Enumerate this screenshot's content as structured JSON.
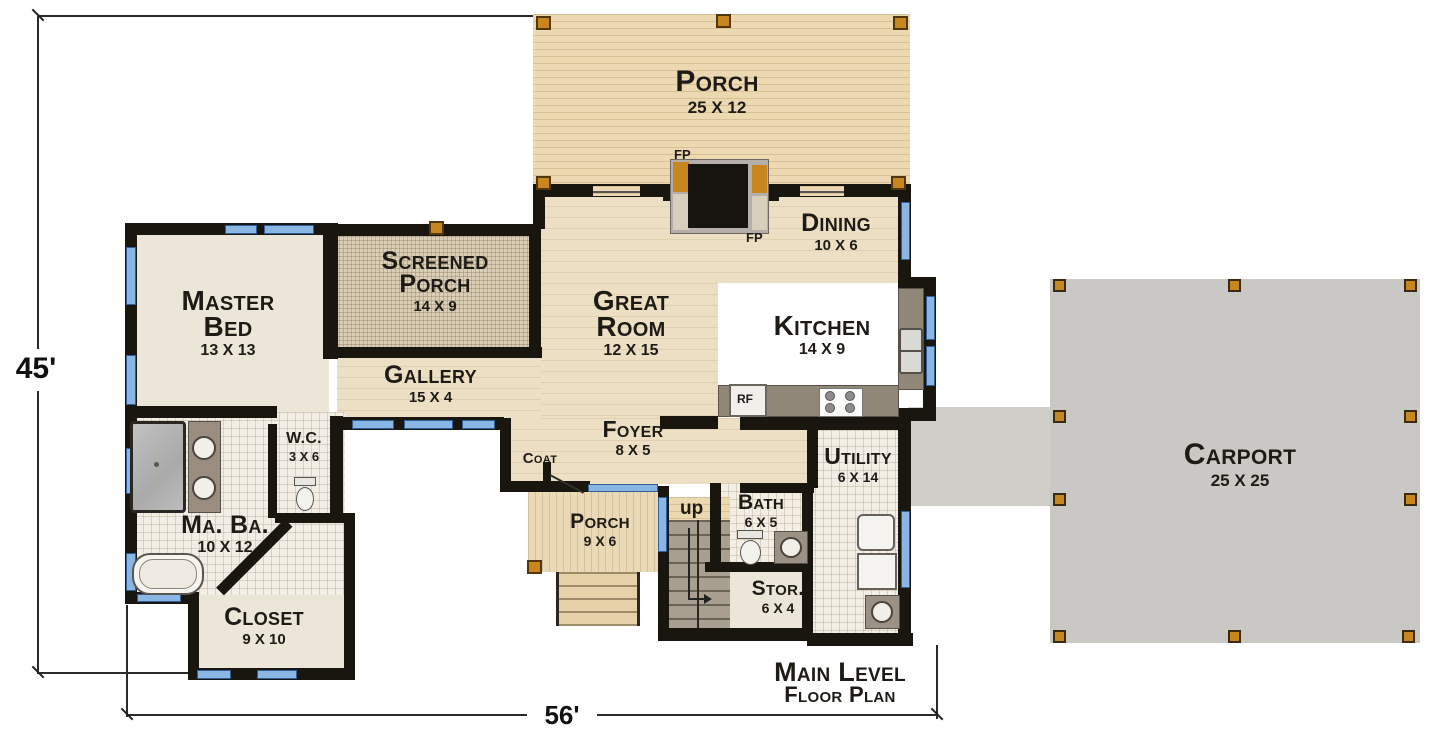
{
  "title": {
    "line1": "Main Level",
    "line2": "Floor Plan"
  },
  "dimensions": {
    "height_label": "45'",
    "width_label": "56'"
  },
  "rooms": {
    "porch_top": {
      "name": "Porch",
      "size": "25 X 12"
    },
    "dining": {
      "name": "Dining",
      "size": "10 X 6"
    },
    "great_room": {
      "name": "Great Room",
      "size": "12 X 15"
    },
    "kitchen": {
      "name": "Kitchen",
      "size": "14 X 9"
    },
    "screened_porch": {
      "name": "Screened Porch",
      "size": "14 X 9"
    },
    "master_bed": {
      "name": "Master Bed",
      "size": "13 X 13"
    },
    "gallery": {
      "name": "Gallery",
      "size": "15 X 4"
    },
    "foyer": {
      "name": "Foyer",
      "size": "8 X 5"
    },
    "coat": {
      "name": "Coat",
      "size": ""
    },
    "wc": {
      "name": "W.C.",
      "size": "3 X 6"
    },
    "ma_ba": {
      "name": "Ma. Ba.",
      "size": "10 X 12"
    },
    "closet": {
      "name": "Closet",
      "size": "9 X 10"
    },
    "porch_bottom": {
      "name": "Porch",
      "size": "9 X 6"
    },
    "bath": {
      "name": "Bath",
      "size": "6 X 5"
    },
    "stor": {
      "name": "Stor.",
      "size": "6 X 4"
    },
    "utility": {
      "name": "Utility",
      "size": "6 X 14"
    },
    "carport": {
      "name": "Carport",
      "size": "25 X 25"
    }
  },
  "annotations": {
    "fp": "FP",
    "rf": "RF",
    "up": "up"
  },
  "colors": {
    "wall": "#19150f",
    "window": "#8ab6e4",
    "post": "#c8861f",
    "porch_wood": "#ecd9b2",
    "interior_wood": "#ecdfc4",
    "tile": "#f3eee5",
    "screened": "#dbceb6",
    "cream": "#ece6d8",
    "carport_concrete": "#c9c8c4"
  }
}
